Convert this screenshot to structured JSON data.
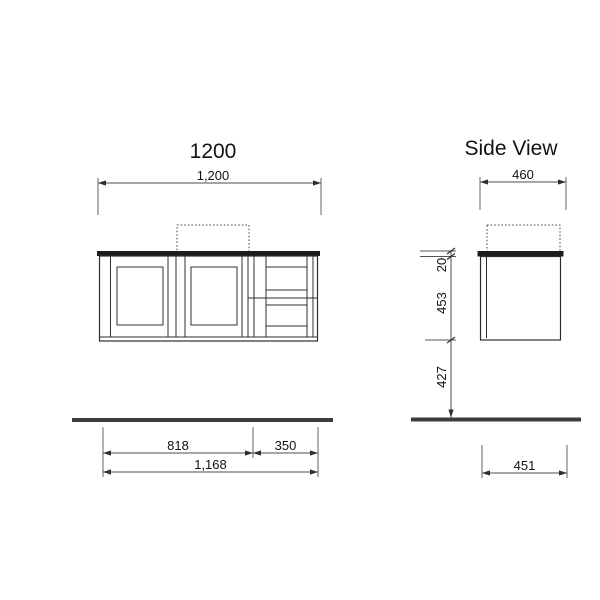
{
  "front_view": {
    "title": "1200",
    "overall_width": "1,200",
    "doors_width": "818",
    "drawers_width": "350",
    "total_width": "1,168"
  },
  "side_view": {
    "title": "Side View",
    "overall_depth": "460",
    "counter_thickness": "20",
    "cabinet_height": "453",
    "floor_clearance": "427",
    "bottom_depth": "451"
  },
  "colors": {
    "countertop": "#1d1d1d",
    "floor": "#3c3c3c",
    "line": "#2d2d2d",
    "dimension": "#4d4d4d",
    "text": "#121212"
  }
}
